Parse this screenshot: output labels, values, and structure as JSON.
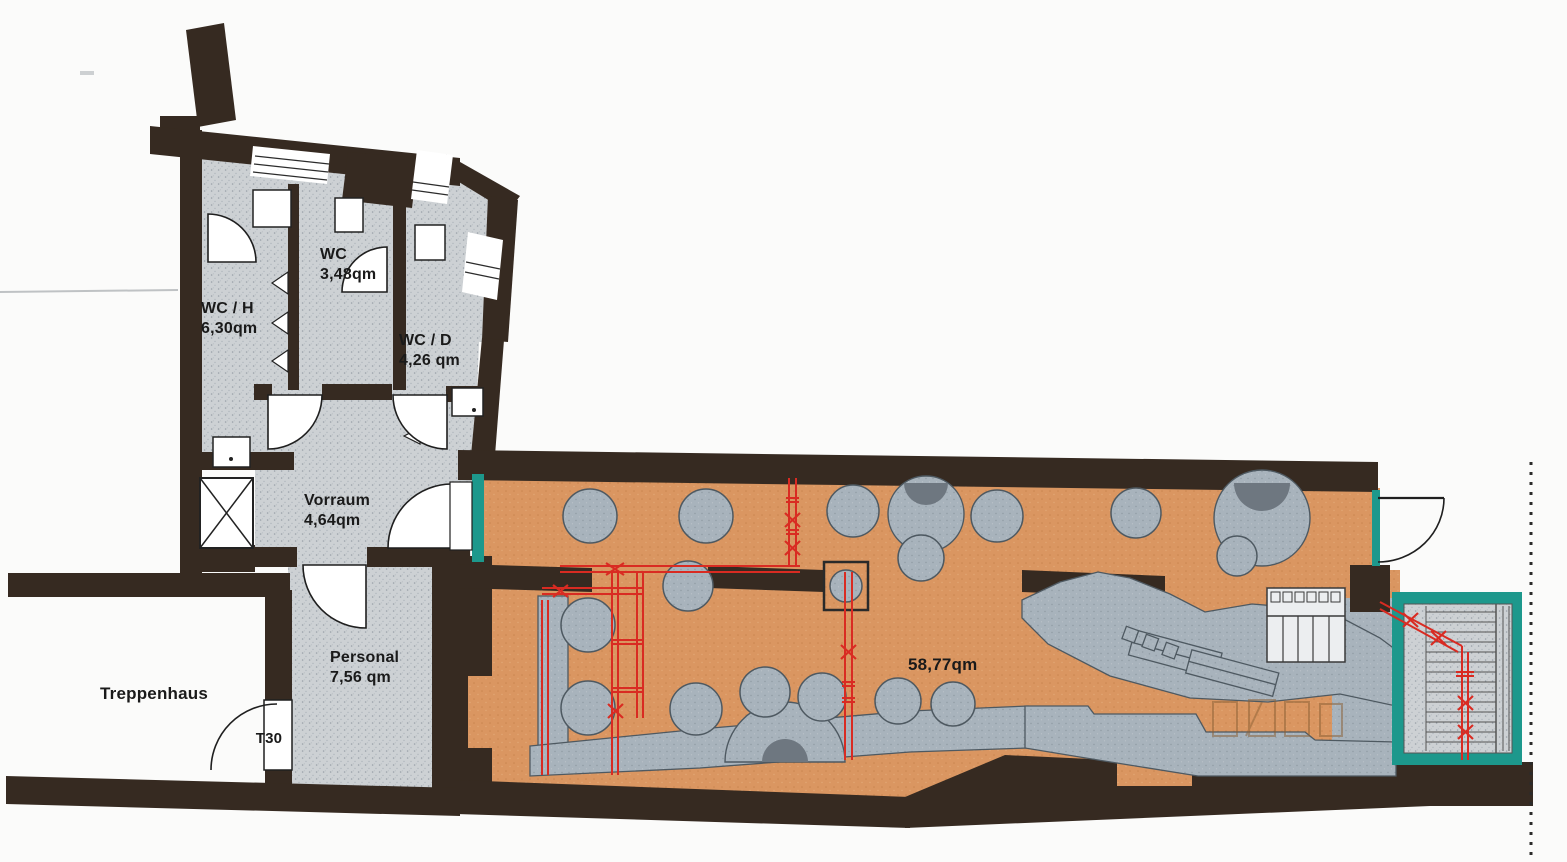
{
  "plan": {
    "rooms": {
      "wc_h": {
        "name": "WC / H",
        "area": "6,30qm"
      },
      "wc": {
        "name": "WC",
        "area": "3,48qm"
      },
      "wc_d": {
        "name": "WC / D",
        "area": "4,26 qm"
      },
      "vorraum": {
        "name": "Vorraum",
        "area": "4,64qm"
      },
      "personal": {
        "name": "Personal",
        "area": "7,56 qm"
      },
      "treppenhaus": {
        "name": "Treppenhaus"
      },
      "main_room": {
        "area": "58,77qm"
      }
    },
    "doors": {
      "t30_label": "T30"
    }
  },
  "colors": {
    "wall": "#362a21",
    "floor": "#cdd1d4",
    "orange": "#da9661",
    "furn": "#a8b3bc",
    "furndark": "#6e7780",
    "teal": "#1d988c",
    "red": "#d92b22",
    "text": "#1a1a1a",
    "line": "#2c2c2c"
  }
}
